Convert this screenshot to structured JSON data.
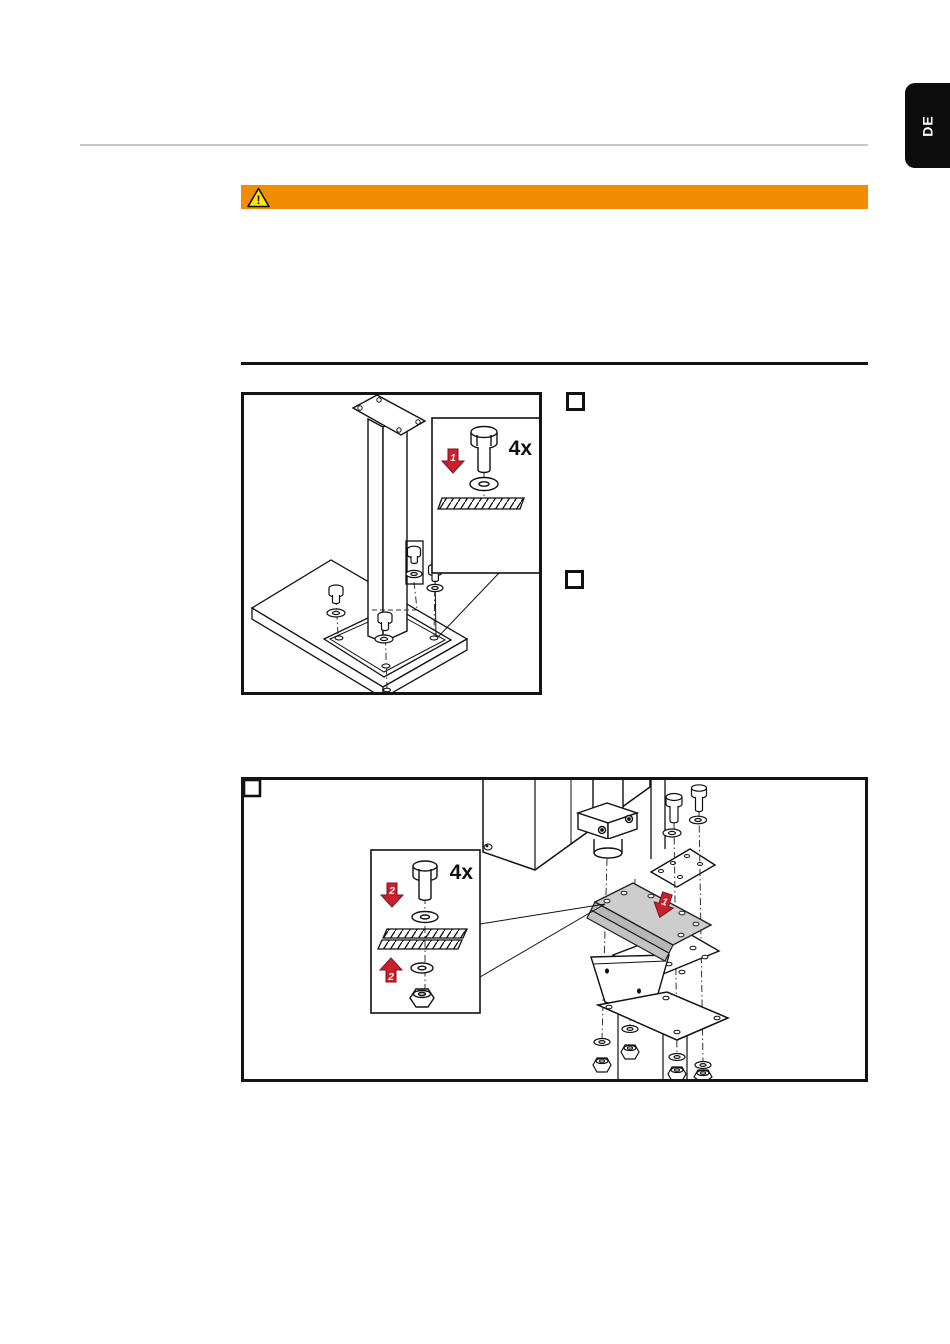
{
  "page": {
    "width": 950,
    "height": 1344,
    "language_tab": "DE"
  },
  "colors": {
    "accent_orange": "#f28c00",
    "warning_yellow": "#ffe900",
    "arrow_red": "#c9202e",
    "arrow_red_dark": "#7e1119",
    "plate_gray": "#cdcdcd",
    "rule_gray": "#c8c8c8",
    "line_black": "#141414",
    "tab_black": "#0c0c0c"
  },
  "warning_banner": {
    "icon": "warning-triangle-icon",
    "exclamation": "!"
  },
  "figure1": {
    "description": "mounting post on base plate with four anchor bolts",
    "quantity_label": "4x",
    "arrow_step_label": "1"
  },
  "figure2": {
    "description": "exploded view of drive housing mounted to adapter plates with bolts, washers and nuts",
    "quantity_label": "4x",
    "arrow_step_down_label": "2",
    "arrow_step_up_label": "2",
    "plate_step_label": "1"
  },
  "steps": {
    "checkbox_count": 2
  }
}
